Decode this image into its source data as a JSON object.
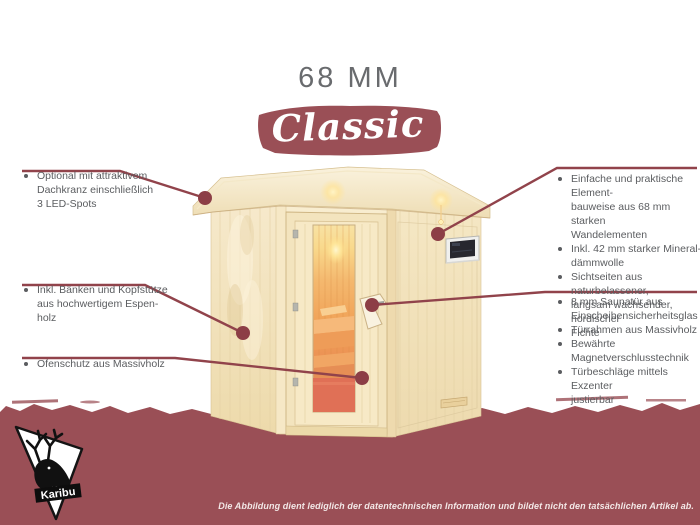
{
  "title": "68 MM",
  "banner": {
    "label": "Classic"
  },
  "brand": {
    "name": "Karibu"
  },
  "disclaimer": "Die Abbildung dient lediglich der datentechnischen Information und bildet nicht den tatsächlichen Artikel ab.",
  "callouts": {
    "left": [
      {
        "lines": [
          "Optional mit attraktivem",
          "Dachkranz einschließlich",
          "3 LED-Spots"
        ]
      },
      {
        "lines": [
          "Inkl. Bänken und Kopfstütze",
          "aus hochwertigem Espen-",
          "holz"
        ]
      },
      {
        "lines": [
          "Ofenschutz aus Massivholz"
        ]
      }
    ],
    "right_top": [
      {
        "lines": [
          "Einfache und praktische Element-",
          "bauweise aus 68 mm starken",
          "Wandelementen"
        ]
      },
      {
        "lines": [
          "Inkl. 42 mm starker Mineral-",
          "dämmwolle"
        ]
      },
      {
        "lines": [
          "Sichtseiten aus naturbelassener,",
          "langsam wachsender, nordischer",
          "Fichte"
        ]
      }
    ],
    "right_bottom": [
      {
        "lines": [
          "8 mm Saunatür aus",
          "Einscheibensicherheitsglas"
        ]
      },
      {
        "lines": [
          "Türrahmen aus Massivholz"
        ]
      },
      {
        "lines": [
          "Bewährte Magnetverschlusstechnik"
        ]
      },
      {
        "lines": [
          "Türbeschläge mittels Exzenter",
          "justierbar"
        ]
      }
    ]
  },
  "colors": {
    "maroon_band": "#9a4f56",
    "callout_line": "#91434b",
    "body_text": "#5b5d60",
    "title_text": "#696b6e",
    "wood_light": "#f5e7c4",
    "glass_warm": "#ef9e55"
  }
}
